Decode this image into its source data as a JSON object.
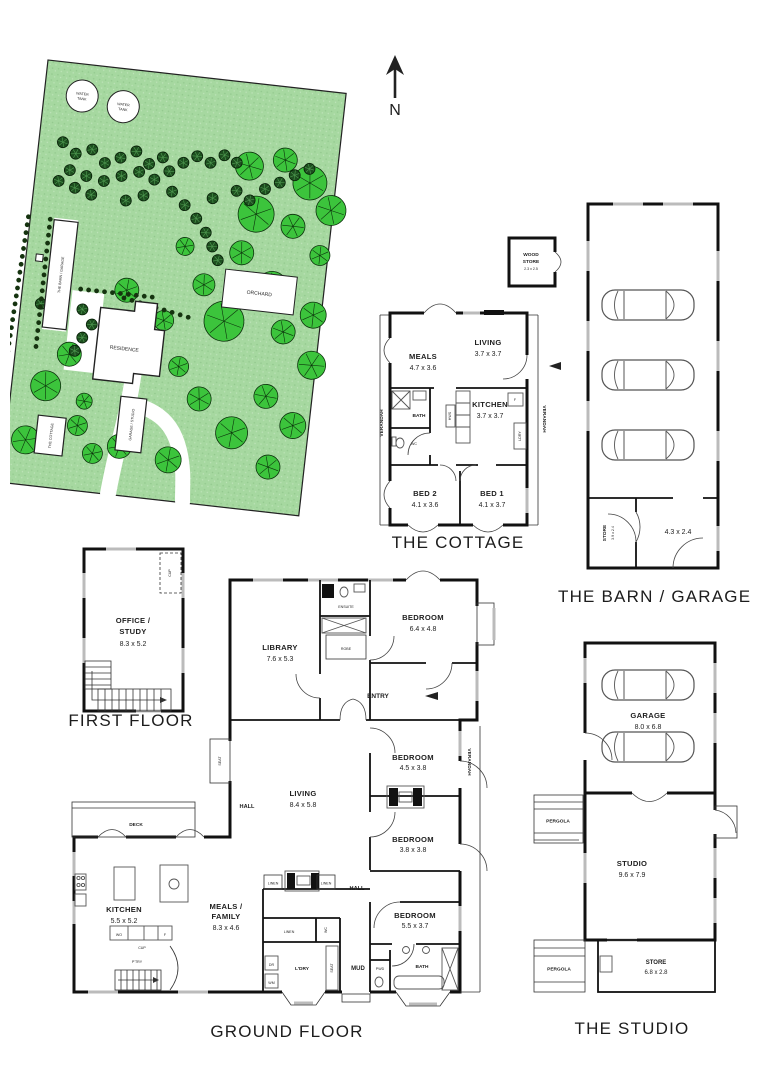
{
  "north_label": "N",
  "site": {
    "water_tank_line1": "WATER",
    "water_tank_line2": "TANK",
    "wood_line1": "WOOD",
    "wood_line2": "STORAGE",
    "barn": "THE BARN / GARAGE",
    "residence": "RESIDENCE",
    "garage_studio": "GARAGE / STUDIO",
    "cottage": "THE COTTAGE",
    "orchard": "ORCHARD"
  },
  "cottage": {
    "title": "THE COTTAGE",
    "meals": {
      "name": "MEALS",
      "size": "4.7 x 3.6"
    },
    "living": {
      "name": "LIVING",
      "size": "3.7 x 3.7"
    },
    "kitchen": {
      "name": "KITCHEN",
      "size": "3.7 x 3.7"
    },
    "bed2": {
      "name": "BED 2",
      "size": "4.1 x 3.6"
    },
    "bed1": {
      "name": "BED 1",
      "size": "4.1 x 3.7"
    },
    "bath": "BATH",
    "wc": "WC",
    "verandah_left": "VERANDAH",
    "verandah_right": "VERANDAH",
    "ldry": "LDRY",
    "hws": "HWS",
    "fridge": "F"
  },
  "wood_store": {
    "line1": "WOOD",
    "line2": "STORE",
    "size": "2.3 x 2.5"
  },
  "barn": {
    "title": "THE BARN / GARAGE",
    "store_name": "STORE",
    "store_size": "3.9 x 2.4",
    "room_size": "4.3 x 2.4"
  },
  "first_floor": {
    "title": "FIRST FLOOR",
    "office_line1": "OFFICE /",
    "office_line2": "STUDY",
    "office_size": "8.3 x 5.2",
    "cup": "CUP"
  },
  "ground": {
    "title": "GROUND FLOOR",
    "library": {
      "name": "LIBRARY",
      "size": "7.6 x 5.3"
    },
    "bedroom_main": {
      "name": "BEDROOM",
      "size": "6.4 x 4.8"
    },
    "ensuite": "ENSUITE",
    "robe": "ROBE",
    "entry": "ENTRY",
    "living": {
      "name": "LIVING",
      "size": "8.4 x 5.8"
    },
    "hall1": "HALL",
    "hall2": "HALL",
    "bedroom2": {
      "name": "BEDROOM",
      "size": "4.5 x 3.8"
    },
    "bedroom3": {
      "name": "BEDROOM",
      "size": "3.8 x 3.8"
    },
    "bedroom4": {
      "name": "BEDROOM",
      "size": "5.5 x 3.7"
    },
    "verandah": "VERANDAH",
    "deck": "DECK",
    "seat": "SEAT",
    "kitchen": {
      "name": "KITCHEN",
      "size": "5.5 x 5.2"
    },
    "meals": {
      "line1": "MEALS /",
      "line2": "FAMILY",
      "size": "8.3 x 4.6"
    },
    "linen1": "LINEN",
    "linen2": "LINEN",
    "linen3": "LINEN",
    "ldry": "L'DRY",
    "mud": "MUD",
    "pwd": "PWD",
    "bath": "BATH",
    "wc": "WC",
    "dr": "DR",
    "wm": "WM",
    "wo": "WO",
    "fridge": "F",
    "cup": "CUP",
    "pantry": "P'TRY"
  },
  "studio": {
    "title": "THE STUDIO",
    "garage": {
      "name": "GARAGE",
      "size": "8.0 x 6.8"
    },
    "studio_room": {
      "name": "STUDIO",
      "size": "9.6 x 7.9"
    },
    "store": {
      "name": "STORE",
      "size": "6.8 x 2.8"
    },
    "pergola1": "PERGOLA",
    "pergola2": "PERGOLA"
  }
}
